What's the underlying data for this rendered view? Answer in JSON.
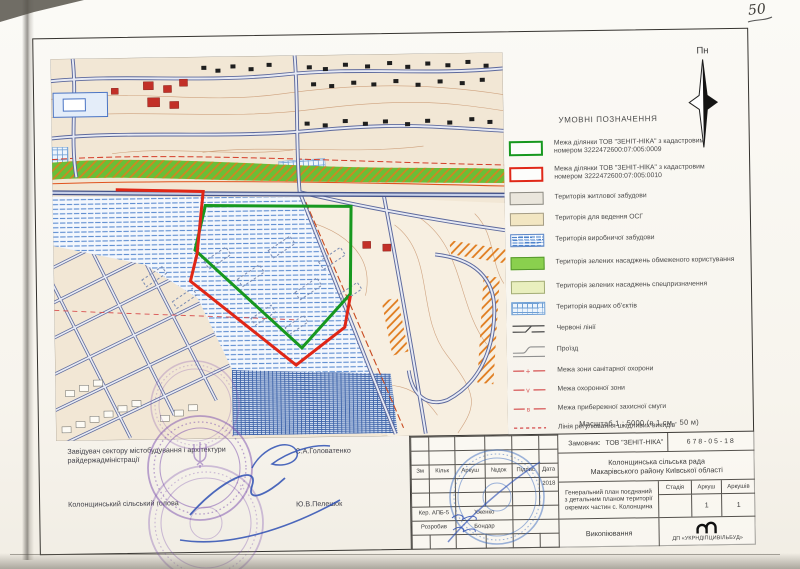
{
  "annotations": {
    "sheet_number": "50"
  },
  "compass": {
    "label": "Пн"
  },
  "legend": {
    "title": "УМОВНІ ПОЗНАЧЕННЯ",
    "items": [
      {
        "swatch": "green-outline",
        "label": "Межа ділянки ТОВ \"ЗЕНІТ-НІКА\" з кадастровим номером 3222472600:07:005:0009"
      },
      {
        "swatch": "red-outline",
        "label": "Межа ділянки ТОВ \"ЗЕНІТ-НІКА\" з кадастровим номером 3222472600:07:005:0010"
      },
      {
        "swatch": "residential-fill",
        "label": "Територія житлової забудови"
      },
      {
        "swatch": "osg-fill",
        "label": "Територія для ведення ОСГ"
      },
      {
        "swatch": "industrial-hatch",
        "label": "Територія виробничої забудови"
      },
      {
        "swatch": "green-limited-fill",
        "label": "Територія зелених насаджень обмеженого користування"
      },
      {
        "swatch": "green-special-fill",
        "label": "Територія зелених насаджень спецпризначення"
      },
      {
        "swatch": "water-grid",
        "label": "Територія водних об’єктів"
      },
      {
        "swatch": "red-lines-symbol",
        "label": "Червоні лінії"
      },
      {
        "swatch": "driveway-symbol",
        "label": "Проїзд"
      },
      {
        "swatch": "sanitary-zone-line",
        "label": "Межа зони санітарної охорони"
      },
      {
        "swatch": "protection-zone-line",
        "label": "Межа охоронної зони"
      },
      {
        "swatch": "coastal-strip-line",
        "label": "Межа прибережної захисної смуги"
      },
      {
        "swatch": "harmful-emissions-line",
        "label": "Лінія регулювання шкідливих викидів"
      }
    ]
  },
  "scale_note": "Масштаб  1 : 5000 (в 1 см - 50 м)",
  "title_block": {
    "client_label": "Замовник:",
    "client_name": "ТОВ \"ЗЕНІТ-НІКА\"",
    "project_code": "678-05-18",
    "authority_line1": "Колонщинська сільська рада",
    "authority_line2": "Макарівського району Київської області",
    "project_title": "Генеральний план поєднаний з детальним планом території окремих частин с. Колонщина",
    "sheet_type": "Викопіювання",
    "columns": {
      "zm": "Зм",
      "kilk": "Кільк",
      "arkush": "Аркуш",
      "doc": "№док",
      "pidpys": "Підпис",
      "data": "Дата"
    },
    "year": "2018",
    "staff": [
      {
        "role": "Кер. АПБ-5",
        "name": "Хженко"
      },
      {
        "role": "Розробив",
        "name": "Бондар"
      }
    ],
    "stage": {
      "headers": [
        "Стадія",
        "Аркуш",
        "Аркушів"
      ],
      "values": [
        "",
        "1",
        "1"
      ]
    },
    "organization": "ДП «УКРНДІПЦИВІЛЬБУД»"
  },
  "signatures": [
    {
      "title": "Завідувач сектору містобудування і архітектури райдержадміністрації",
      "name": "С.А.Головатенко"
    },
    {
      "title": "Колонщинський сільський голова",
      "name": "Ю.В.Пелешок"
    }
  ],
  "colors": {
    "parcel_green": "#17981f",
    "parcel_red": "#e02818",
    "stamp_purple": "#7b4fae",
    "stamp_blue": "#3f6ec0"
  }
}
